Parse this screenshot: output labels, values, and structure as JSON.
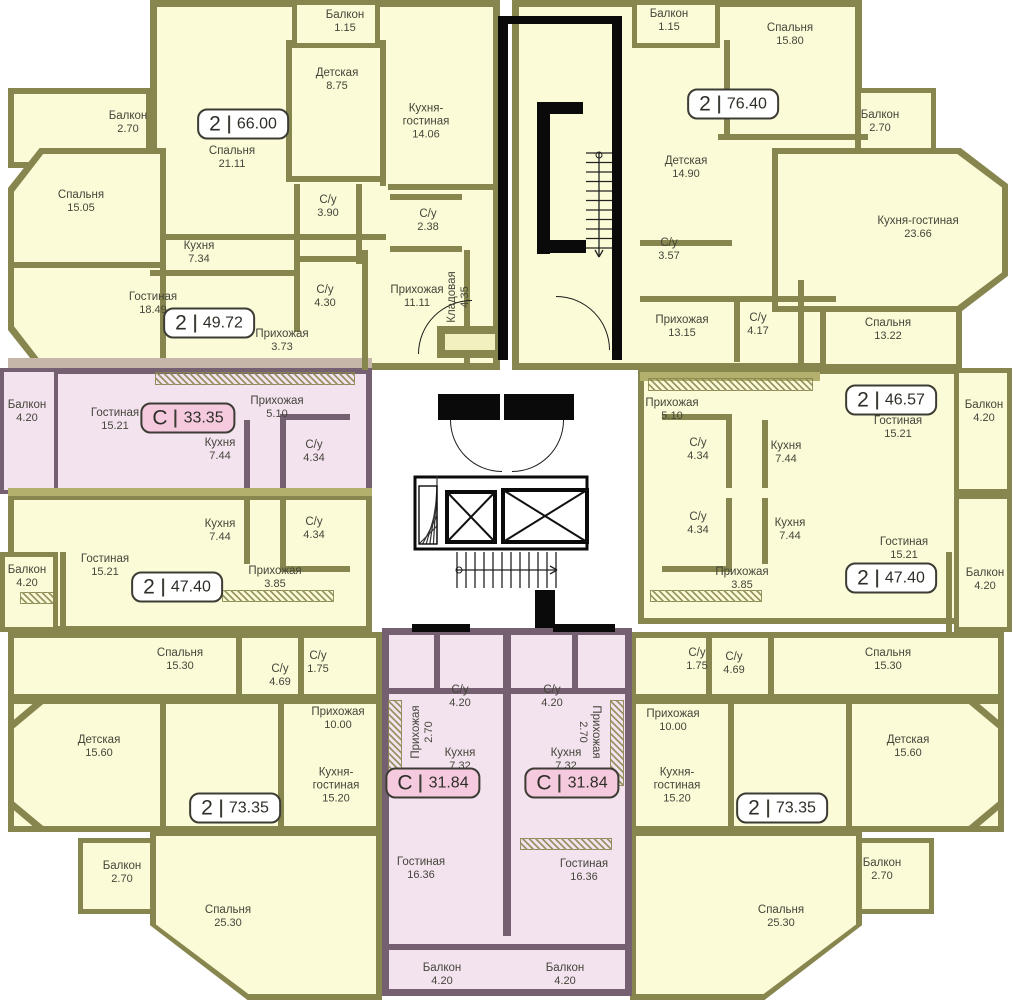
{
  "title": "floor-plan",
  "colors": {
    "wall": "#87864f",
    "wall_light": "#abaa6b",
    "apartment_fill": "#fcfbd8",
    "studio_fill": "#f3e3ef",
    "studio_wall": "#746070",
    "band_tan": "#c6b5a9",
    "band_olive": "#b3b06d",
    "badge_fill": "#ffffff",
    "badge_studio_fill": "#f5cadf",
    "badge_border": "#3c3c34",
    "text": "#45453a",
    "core": "#0a0a0a"
  },
  "apartments": [
    {
      "id": "left-top-2-66",
      "badge": {
        "type": "2",
        "area": "66.00",
        "x": 243,
        "y": 124,
        "style": "standard"
      },
      "rooms": [
        {
          "name": "Балкон",
          "area": "1.15",
          "x": 345,
          "y": 22
        },
        {
          "name": "Детская",
          "area": "8.75",
          "x": 337,
          "y": 80
        },
        {
          "name": "Спальня",
          "area": "21.11",
          "x": 232,
          "y": 158
        },
        {
          "name": "Кухня-\nгостиная",
          "area": "14.06",
          "x": 426,
          "y": 122
        },
        {
          "name": "С/у",
          "area": "3.90",
          "x": 328,
          "y": 207
        },
        {
          "name": "С/у",
          "area": "2.38",
          "x": 428,
          "y": 221
        },
        {
          "name": "Прихожая",
          "area": "11.11",
          "x": 417,
          "y": 297
        },
        {
          "name": "Кладовая",
          "area": "4.35",
          "x": 459,
          "y": 297,
          "rot": -90
        }
      ]
    },
    {
      "id": "left-2-49",
      "badge": {
        "type": "2",
        "area": "49.72",
        "x": 209,
        "y": 323,
        "style": "standard"
      },
      "rooms": [
        {
          "name": "Балкон",
          "area": "2.70",
          "x": 128,
          "y": 123
        },
        {
          "name": "Спальня",
          "area": "15.05",
          "x": 81,
          "y": 202
        },
        {
          "name": "Кухня",
          "area": "7.34",
          "x": 199,
          "y": 253
        },
        {
          "name": "Гостиная",
          "area": "18.49",
          "x": 153,
          "y": 304
        },
        {
          "name": "С/у",
          "area": "4.30",
          "x": 325,
          "y": 297
        },
        {
          "name": "Прихожая",
          "area": "3.73",
          "x": 282,
          "y": 341
        }
      ]
    },
    {
      "id": "left-studio-33",
      "badge": {
        "type": "С",
        "area": "33.35",
        "x": 188,
        "y": 418,
        "style": "studio"
      },
      "rooms": [
        {
          "name": "Балкон",
          "area": "4.20",
          "x": 27,
          "y": 412
        },
        {
          "name": "Гостиная",
          "area": "15.21",
          "x": 115,
          "y": 420
        },
        {
          "name": "Прихожая",
          "area": "5.10",
          "x": 277,
          "y": 408
        },
        {
          "name": "Кухня",
          "area": "7.44",
          "x": 220,
          "y": 450
        },
        {
          "name": "С/у",
          "area": "4.34",
          "x": 314,
          "y": 452
        }
      ]
    },
    {
      "id": "left-2-47",
      "badge": {
        "type": "2",
        "area": "47.40",
        "x": 177,
        "y": 587,
        "style": "standard"
      },
      "rooms": [
        {
          "name": "Кухня",
          "area": "7.44",
          "x": 220,
          "y": 531
        },
        {
          "name": "С/у",
          "area": "4.34",
          "x": 314,
          "y": 529
        },
        {
          "name": "Гостиная",
          "area": "15.21",
          "x": 105,
          "y": 566
        },
        {
          "name": "Балкон",
          "area": "4.20",
          "x": 27,
          "y": 577
        },
        {
          "name": "Прихожая",
          "area": "3.85",
          "x": 275,
          "y": 578
        },
        {
          "name": "Спальня",
          "area": "15.30",
          "x": 180,
          "y": 660
        }
      ]
    },
    {
      "id": "left-2-73",
      "badge": {
        "type": "2",
        "area": "73.35",
        "x": 235,
        "y": 808,
        "style": "standard"
      },
      "rooms": [
        {
          "name": "С/у",
          "area": "4.69",
          "x": 280,
          "y": 676
        },
        {
          "name": "С/у",
          "area": "1.75",
          "x": 318,
          "y": 663
        },
        {
          "name": "Прихожая",
          "area": "10.00",
          "x": 338,
          "y": 719
        },
        {
          "name": "Детская",
          "area": "15.60",
          "x": 99,
          "y": 747
        },
        {
          "name": "Кухня-\nгостиная",
          "area": "15.20",
          "x": 336,
          "y": 786
        },
        {
          "name": "Балкон",
          "area": "2.70",
          "x": 122,
          "y": 873
        },
        {
          "name": "Спальня",
          "area": "25.30",
          "x": 228,
          "y": 917
        }
      ]
    },
    {
      "id": "center-studio-31-left",
      "badge": {
        "type": "С",
        "area": "31.84",
        "x": 433,
        "y": 783,
        "style": "studio"
      },
      "rooms": [
        {
          "name": "С/у",
          "area": "4.20",
          "x": 460,
          "y": 697
        },
        {
          "name": "Прихожая",
          "area": "2.70",
          "x": 423,
          "y": 732,
          "rot": -90
        },
        {
          "name": "Кухня",
          "area": "7.32",
          "x": 460,
          "y": 760
        },
        {
          "name": "Гостиная",
          "area": "16.36",
          "x": 421,
          "y": 869
        },
        {
          "name": "Балкон",
          "area": "4.20",
          "x": 442,
          "y": 975
        }
      ]
    },
    {
      "id": "center-studio-31-right",
      "badge": {
        "type": "С",
        "area": "31.84",
        "x": 572,
        "y": 783,
        "style": "studio"
      },
      "rooms": [
        {
          "name": "С/у",
          "area": "4.20",
          "x": 552,
          "y": 697
        },
        {
          "name": "Прихожая",
          "area": "2.70",
          "x": 589,
          "y": 732,
          "rot": 90
        },
        {
          "name": "Кухня",
          "area": "7.32",
          "x": 566,
          "y": 760
        },
        {
          "name": "Гостиная",
          "area": "16.36",
          "x": 584,
          "y": 871
        },
        {
          "name": "Балкон",
          "area": "4.20",
          "x": 565,
          "y": 975
        }
      ]
    },
    {
      "id": "right-top-2-76",
      "badge": {
        "type": "2",
        "area": "76.40",
        "x": 733,
        "y": 104,
        "style": "standard"
      },
      "rooms": [
        {
          "name": "Балкон",
          "area": "1.15",
          "x": 669,
          "y": 21
        },
        {
          "name": "Спальня",
          "area": "15.80",
          "x": 790,
          "y": 35
        },
        {
          "name": "Детская",
          "area": "14.90",
          "x": 686,
          "y": 168
        },
        {
          "name": "Балкон",
          "area": "2.70",
          "x": 880,
          "y": 122
        },
        {
          "name": "Кухня-гостиная",
          "area": "23.66",
          "x": 918,
          "y": 228
        },
        {
          "name": "С/у",
          "area": "3.57",
          "x": 669,
          "y": 250
        },
        {
          "name": "Прихожая",
          "area": "13.15",
          "x": 682,
          "y": 327
        },
        {
          "name": "С/у",
          "area": "4.17",
          "x": 758,
          "y": 325
        }
      ]
    },
    {
      "id": "right-2-46",
      "badge": {
        "type": "2",
        "area": "46.57",
        "x": 891,
        "y": 400,
        "style": "standard"
      },
      "rooms": [
        {
          "name": "Спальня",
          "area": "13.22",
          "x": 888,
          "y": 330
        },
        {
          "name": "Прихожая",
          "area": "5.10",
          "x": 672,
          "y": 410
        },
        {
          "name": "Гостиная",
          "area": "15.21",
          "x": 898,
          "y": 428
        },
        {
          "name": "Балкон",
          "area": "4.20",
          "x": 984,
          "y": 412
        },
        {
          "name": "С/у",
          "area": "4.34",
          "x": 698,
          "y": 450
        },
        {
          "name": "Кухня",
          "area": "7.44",
          "x": 786,
          "y": 453
        }
      ]
    },
    {
      "id": "right-2-47",
      "badge": {
        "type": "2",
        "area": "47.40",
        "x": 891,
        "y": 578,
        "style": "standard"
      },
      "rooms": [
        {
          "name": "С/у",
          "area": "4.34",
          "x": 698,
          "y": 524
        },
        {
          "name": "Кухня",
          "area": "7.44",
          "x": 790,
          "y": 530
        },
        {
          "name": "Гостиная",
          "area": "15.21",
          "x": 904,
          "y": 549
        },
        {
          "name": "Прихожая",
          "area": "3.85",
          "x": 742,
          "y": 579
        },
        {
          "name": "Балкон",
          "area": "4.20",
          "x": 985,
          "y": 580
        },
        {
          "name": "Спальня",
          "area": "15.30",
          "x": 888,
          "y": 660
        }
      ]
    },
    {
      "id": "right-2-73",
      "badge": {
        "type": "2",
        "area": "73.35",
        "x": 782,
        "y": 808,
        "style": "standard"
      },
      "rooms": [
        {
          "name": "С/у",
          "area": "1.75",
          "x": 697,
          "y": 660
        },
        {
          "name": "С/у",
          "area": "4.69",
          "x": 734,
          "y": 664
        },
        {
          "name": "Прихожая",
          "area": "10.00",
          "x": 673,
          "y": 721
        },
        {
          "name": "Детская",
          "area": "15.60",
          "x": 908,
          "y": 747
        },
        {
          "name": "Кухня-\nгостиная",
          "area": "15.20",
          "x": 677,
          "y": 786
        },
        {
          "name": "Балкон",
          "area": "2.70",
          "x": 882,
          "y": 870
        },
        {
          "name": "Спальня",
          "area": "25.30",
          "x": 781,
          "y": 917
        }
      ]
    }
  ]
}
